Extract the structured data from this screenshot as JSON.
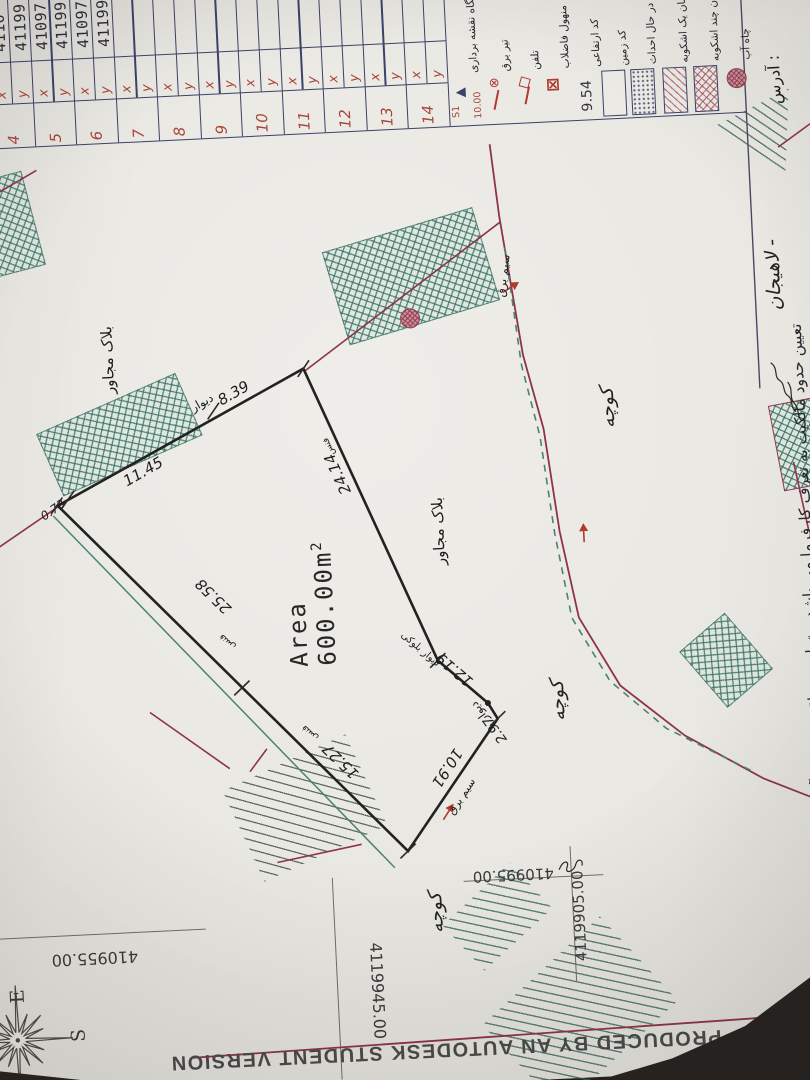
{
  "document": {
    "banner": "PRODUCED BY AN AUTODESK STUDENT VERSION",
    "disclaimer": "تعیین حدود مالکیت به تعرف کارفرما می باشد و تمامی عواقب حقوقی آن بر عهده وی می باشد",
    "address_label": "آدرس :",
    "address_city": "لاهیجان -"
  },
  "coordinate_table": {
    "x_label": "x",
    "y_label": "y",
    "rows": [
      {
        "n": "4",
        "x": "4110",
        "y": "41199"
      },
      {
        "n": "5",
        "x": "41097",
        "y": "41199"
      },
      {
        "n": "6",
        "x": "41097",
        "y": "41199"
      },
      {
        "n": "7",
        "x": "",
        "y": ""
      },
      {
        "n": "8",
        "x": "",
        "y": ""
      },
      {
        "n": "9",
        "x": "",
        "y": ""
      },
      {
        "n": "10",
        "x": "",
        "y": ""
      },
      {
        "n": "11",
        "x": "",
        "y": ""
      },
      {
        "n": "12",
        "x": "",
        "y": ""
      },
      {
        "n": "13",
        "x": "",
        "y": ""
      },
      {
        "n": "14",
        "x": "",
        "y": ""
      }
    ]
  },
  "legend": {
    "items": [
      {
        "id": "survey-station",
        "label": "ایستگاه نقشه برداری",
        "sym_top": "S1",
        "sym_bottom": "10.00"
      },
      {
        "id": "power-pole",
        "label": "تیر برق"
      },
      {
        "id": "telephone",
        "label": "تلفن"
      },
      {
        "id": "sewer-manhole",
        "label": "منهول فاضلاب"
      },
      {
        "id": "elevation-code",
        "label": "کد ارتفاعی",
        "value": "9.54"
      },
      {
        "id": "land-code",
        "label": "کد زمین"
      },
      {
        "id": "under-construction",
        "label": "ساختمان در حال احداث"
      },
      {
        "id": "one-story-building",
        "label": "ساختمان یک اشکوبه"
      },
      {
        "id": "multi-story-building",
        "label": "ساختمان چند اشکوبه"
      },
      {
        "id": "water-well",
        "label": "چاه آب"
      }
    ]
  },
  "parcel": {
    "area_label": "Area",
    "area_value": "600.00m",
    "area_sup": "2",
    "dimensions": {
      "d073": "0.73",
      "d1145": "11.45",
      "d839": "8.39",
      "d2558": "25.58",
      "d1527": "15.27",
      "d1091": "10.91",
      "d297": "2.97",
      "d1219": "12.19",
      "d2414": "24.14"
    },
    "labels": {
      "wall": "دیوار",
      "block_wall": "دیوار بلوکی",
      "fence": "فنس",
      "power_line": "سیم برق",
      "adjacent_block": "بلاک مجاور",
      "alley": "کوچه"
    }
  },
  "grid": {
    "e1": "410955.00",
    "n1": "4119945.00",
    "e2": "410995.00",
    "n2": "4119905.00"
  },
  "compass": {
    "east": "E",
    "south": "S"
  }
}
